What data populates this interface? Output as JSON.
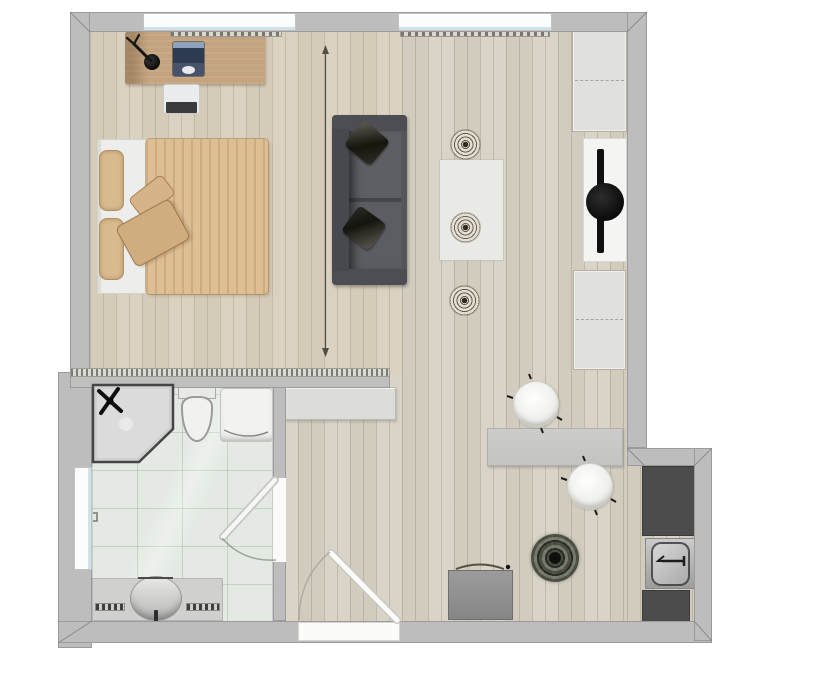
{
  "scene": {
    "title": "Studio apartment floor plan",
    "view": "2D top-down",
    "background_color": "#ffffff"
  },
  "palette": {
    "wall": "#bdbdbd",
    "wall_outline": "#9b9b9b",
    "wood_floor": "#d8d3c7",
    "bathroom_tile": "#e4eae3",
    "kitchen_counter": "#4c4c4c",
    "sofa_fabric": "#55565b",
    "bed_linen": "#debf94",
    "desk_wood": "#c4a47e",
    "cabinet": "#e0e0de",
    "window_glass": "#cfe3ee"
  },
  "rooms": {
    "bedroom": {
      "label": "Bedroom",
      "floor": "light wood planks"
    },
    "living": {
      "label": "Living and dining area",
      "floor": "light wood planks"
    },
    "bathroom": {
      "label": "Bathroom",
      "floor": "mint tile"
    },
    "kitchen": {
      "label": "Kitchen nook",
      "floor": "light wood planks"
    }
  },
  "furniture": {
    "desk": {
      "label": "Desk"
    },
    "laptop": {
      "label": "Open laptop"
    },
    "desk_lamp": {
      "label": "Desk lamp"
    },
    "desk_chair": {
      "label": "Desk chair"
    },
    "bed": {
      "label": "Double bed"
    },
    "bed_pillows": {
      "label": "Bed pillow",
      "count": 2
    },
    "bed_cushions": {
      "label": "Decorative cushion",
      "count": 2
    },
    "sideboard": {
      "label": "Sideboard"
    },
    "sofa": {
      "label": "Two-seat sofa"
    },
    "sofa_cushions": {
      "label": "Sofa cushion",
      "count": 2
    },
    "rug": {
      "label": "Rug"
    },
    "pouf": {
      "label": "Round rattan pouf",
      "count": 3
    },
    "wardrobe_top": {
      "label": "Wardrobe"
    },
    "media_unit": {
      "label": "Media panel with TV and round speaker"
    },
    "wardrobe_bottom": {
      "label": "Wardrobe"
    },
    "dining_table": {
      "label": "Dining table"
    },
    "dining_chair": {
      "label": "Dining chair",
      "count": 2
    },
    "storage_chest": {
      "label": "Storage chest"
    },
    "plant": {
      "label": "Potted plant"
    },
    "shower": {
      "label": "Corner shower"
    },
    "toilet": {
      "label": "Toilet"
    },
    "bath_sink": {
      "label": "Washbasin cabinet"
    },
    "vanity": {
      "label": "Vanity counter with round basin"
    },
    "kitchen_counter": {
      "label": "Kitchen counter",
      "count": 2
    },
    "kitchen_sink": {
      "label": "Kitchen sink with faucet"
    }
  },
  "architecture": {
    "window": {
      "label": "Window",
      "count": 3
    },
    "radiator": {
      "label": "Radiator",
      "count": 2
    },
    "entrance_door": {
      "label": "Entrance door, swings inward"
    },
    "bathroom_door": {
      "label": "Bathroom door, swings inward"
    },
    "divider_line": {
      "label": "Room divider dimension line"
    }
  }
}
